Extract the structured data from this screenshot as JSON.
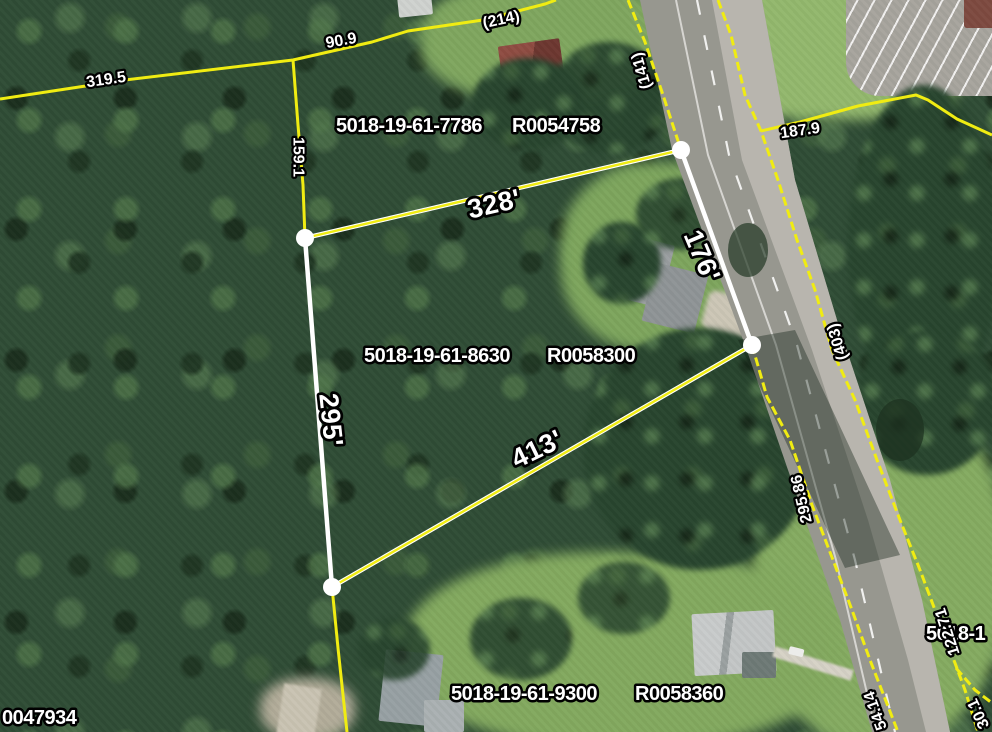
{
  "map": {
    "parcel_labels": [
      {
        "pin": "5018-19-61-7786",
        "reid": "R0054758"
      },
      {
        "pin": "5018-19-61-8630",
        "reid": "R0058300"
      },
      {
        "pin": "5018-19-61-9300",
        "reid": "R0058360"
      }
    ],
    "partial_labels": {
      "southwest_reid": "0047934",
      "east_pin": "5018-1"
    },
    "selected_parcel": {
      "edge_lengths": [
        "328'",
        "176'",
        "413'",
        "295'"
      ]
    },
    "boundary_measurements": [
      "319.5",
      "90.9",
      "(214)",
      "159.1",
      "(141)",
      "187.9",
      "(403)",
      "295.86",
      "122.71",
      "54.14",
      "30.1"
    ],
    "colors": {
      "boundary_line": "#f0ec12",
      "selection_line": "#ffffff",
      "label_text": "#ffffff",
      "label_outline": "#000000",
      "road_surface": "#97978f",
      "road_shoulder": "#b8b5ae"
    }
  }
}
